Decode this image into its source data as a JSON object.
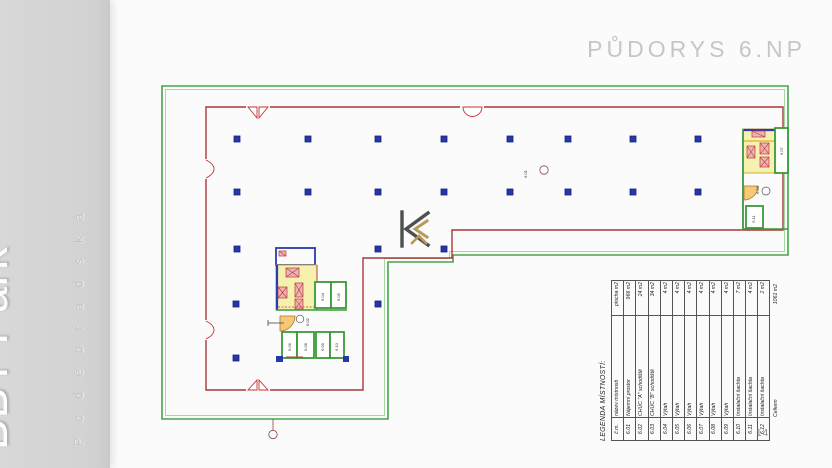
{
  "sidebar": {
    "brand": "BBT Park",
    "street": "P o d ě b r a d s k á"
  },
  "header": {
    "title": "PŮDORYS 6.NP"
  },
  "page": {
    "number": "14"
  },
  "legend": {
    "title": "LEGENDA MÍSTNOSTÍ:",
    "columns": {
      "num": "č.m.",
      "name": "název místnosti",
      "area": "plocha m2"
    },
    "rows": [
      {
        "num": "6.01",
        "name": "Nájemní prostor",
        "area": "966 m2"
      },
      {
        "num": "6.02",
        "name": "CHÚC \"A\" schodiště",
        "area": "24 m2"
      },
      {
        "num": "6.03",
        "name": "CHÚC \"B\" schodiště",
        "area": "34 m2"
      },
      {
        "num": "6.04",
        "name": "Výtah",
        "area": "4 m2"
      },
      {
        "num": "6.05",
        "name": "Výtah",
        "area": "4 m2"
      },
      {
        "num": "6.06",
        "name": "Výtah",
        "area": "4 m2"
      },
      {
        "num": "6.07",
        "name": "Výtah",
        "area": "4 m2"
      },
      {
        "num": "6.08",
        "name": "Výtah",
        "area": "4 m2"
      },
      {
        "num": "6.09",
        "name": "Výtah",
        "area": "4 m2"
      },
      {
        "num": "6.10",
        "name": "Instalační šachta",
        "area": "7 m2"
      },
      {
        "num": "6.11",
        "name": "Instalační šachta",
        "area": "4 m2"
      },
      {
        "num": "6.12",
        "name": "Instalační šachta",
        "area": "2 m2"
      }
    ],
    "total": {
      "label": "Celkem",
      "area": "1061 m2"
    }
  },
  "plan": {
    "labels": {
      "main_room": "6.01",
      "corridor": "6.02",
      "stair_b": "6.03",
      "lift1": "6.04",
      "lift2": "6.05",
      "lift3": "6.06",
      "lift4": "6.08",
      "lift5": "6.09",
      "shaft1": "6.10",
      "lift6": "6.07",
      "shaft2": "6.11"
    },
    "colors": {
      "boundary_green": "#49a449",
      "facade_red": "#a83838",
      "column_blue": "#2438a8",
      "stair_yellow": "#f6f1ae",
      "door_orange": "#f6c877"
    }
  }
}
